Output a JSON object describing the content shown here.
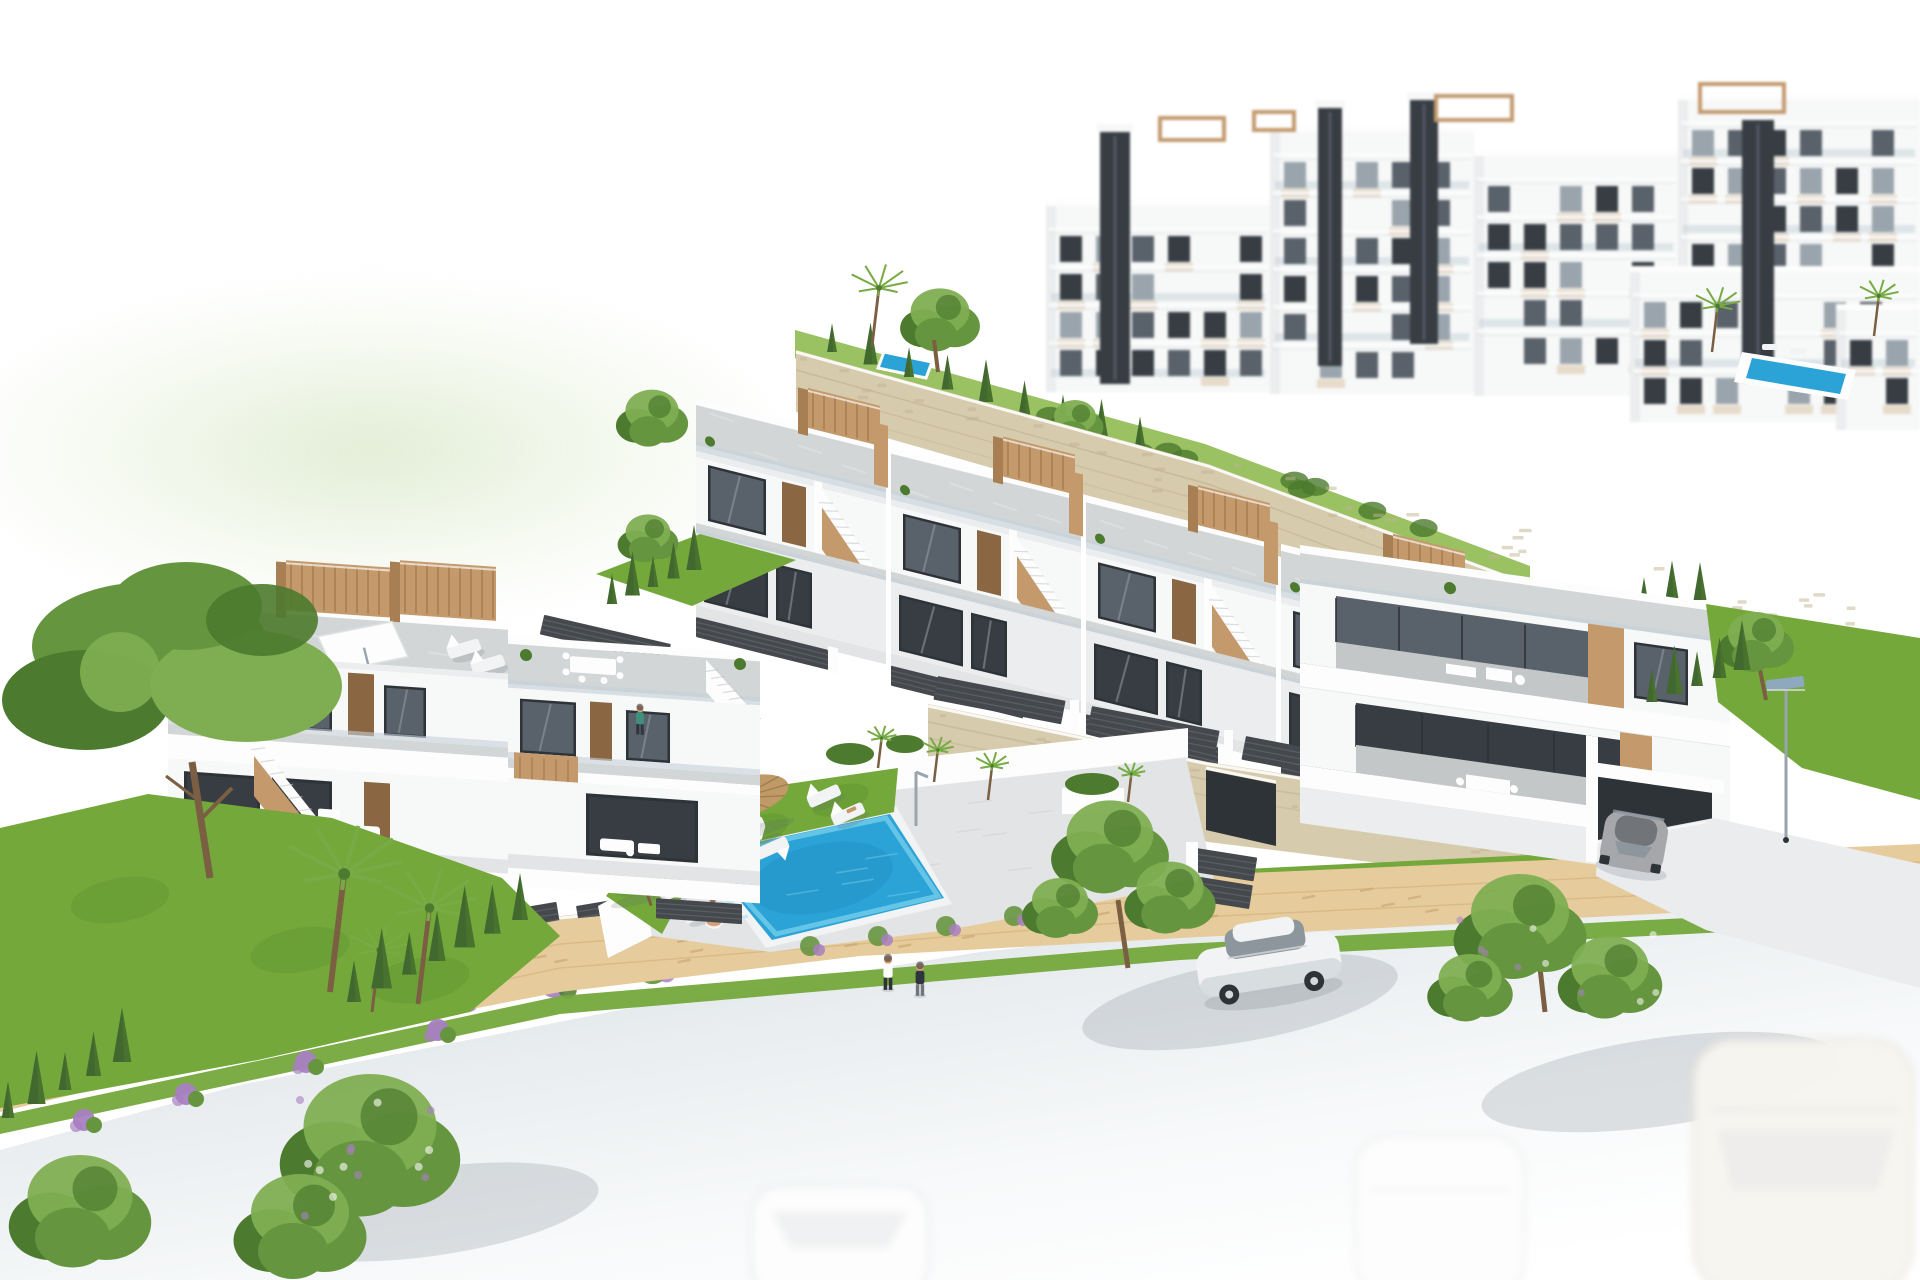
{
  "meta": {
    "type": "architectural-3d-render",
    "description": "Aerial 3D visualization of a hillside residential development: two rows of white terraced townhouses with tan rooftop pergolas and external stairs, a communal swimming pool with sun loungers and straw umbrellas, large white apartment blocks behind a stone retaining wall, gardens with pines, palms and cypresses, and a curving street with a white sedan, a grey sports car at a garage drive, two pedestrians and faint parked cars fading out at the bottom edge."
  },
  "scene": {
    "background": [
      "apartment-blocks",
      "pale-green-hill",
      "amenity-lawn-with-lap-pool",
      "small-background-pool"
    ],
    "midground": [
      "upper-stone-retaining-wall",
      "townhouse-row-of-four",
      "right-corner-building",
      "lower-stone-wall-with-garage-door",
      "street-lamps"
    ],
    "foreground": [
      "left-townhouse-block",
      "communal-pool-area",
      "left-garden",
      "street-with-sidewalk",
      "ghost-parked-cars"
    ],
    "counts": {
      "townhouse-units": 4,
      "pool-loungers": 7,
      "straw-umbrellas": 2,
      "pedestrians": 2,
      "cars-clear": 2,
      "cars-faded": 3,
      "people-at-pool": 2,
      "people-on-balconies": 1
    }
  },
  "palette": {
    "white": "#fdfdfd",
    "building": "#f7f8f8",
    "buildingShade": "#ecedee",
    "buildingShadow": "#dfe2e3",
    "deck": "#d2d6d7",
    "deckDark": "#c3c7c8",
    "deckLight": "#e3e4e6",
    "glassDark": "#373d43",
    "glassMid": "#59616a",
    "glassLight": "#9aa4ac",
    "glassReflect": "#c6d1d9",
    "frame": "#2e3338",
    "wood": "#c49a6d",
    "woodDark": "#a87f53",
    "door": "#8a6742",
    "beige": "#dcc8ab",
    "stone": "#d7cbae",
    "stoneLine": "#c2b391",
    "grass": "#74a83b",
    "grassLight": "#9ac162",
    "grassDark": "#5c9230",
    "cypress": "#41682f",
    "tree": "#66953f",
    "treeLight": "#7fae52",
    "treeDark": "#4c7a2e",
    "trunk": "#7a5f43",
    "palm": "#76ab45",
    "poolBlue": "#2ba3d6",
    "poolLight": "#6fcbea",
    "poolDark": "#1b85b8",
    "poolPale": "#bfe6f4",
    "umbrella": "#c09a66",
    "umbrellaDark": "#97754a",
    "fence": "#45494d",
    "fenceLight": "#5d6266",
    "sidewalk": "#e6cc9c",
    "cobble": "#c9a671",
    "drive": "#eaecee",
    "carBody": "#f2f3f4",
    "carShade": "#d4d8da",
    "carGlass": "#8d969c",
    "carGrey": "#a6a7ab",
    "carGreyDark": "#717479",
    "skin": "#d9a078",
    "pink": "#e0569a",
    "teal": "#3f8f7a",
    "navy": "#2e3440",
    "purple": "#a87fc2",
    "lamp": "#8fa9c4",
    "cream": "#f7f5f0",
    "shadow": "rgba(90,100,110,0.18)"
  }
}
